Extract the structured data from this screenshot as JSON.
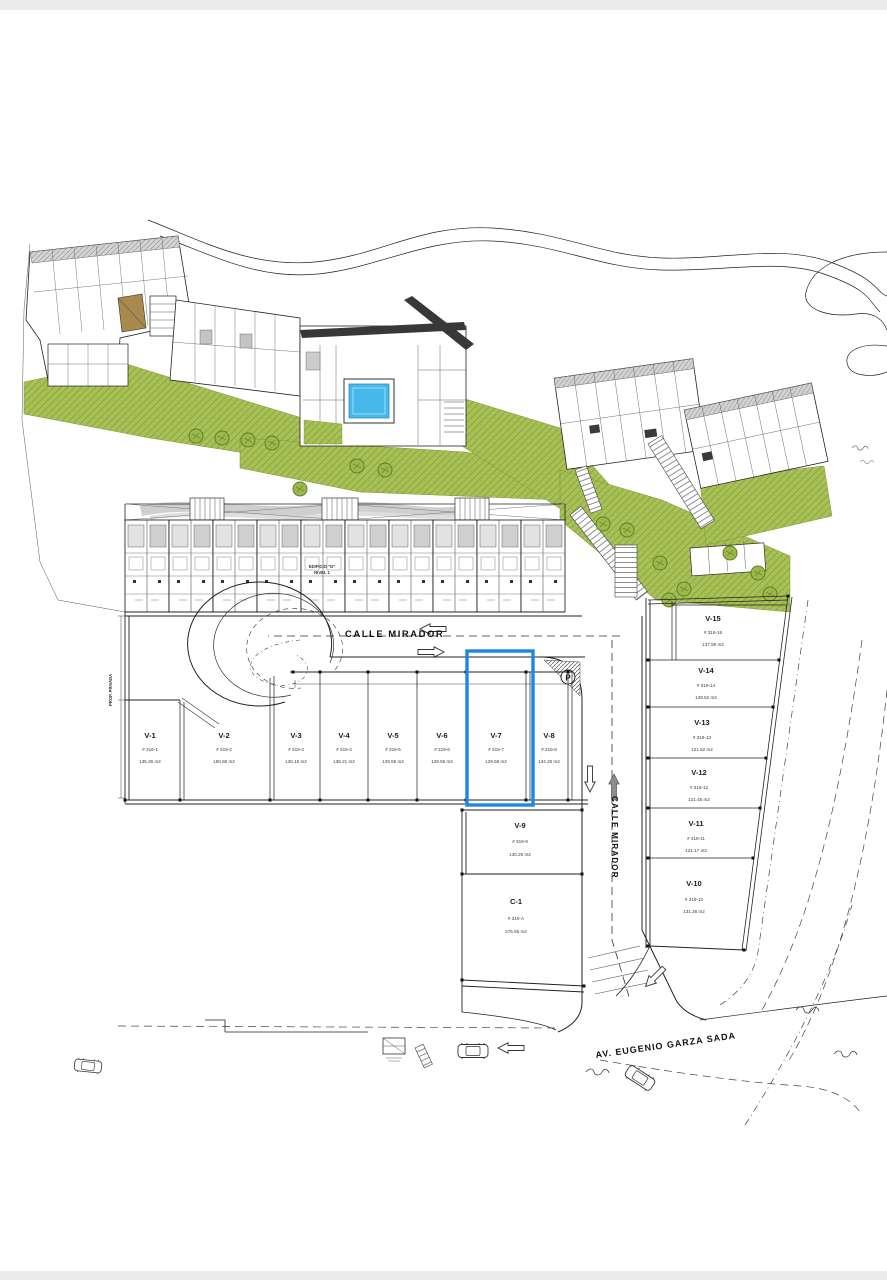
{
  "plan": {
    "title_area": "site plan",
    "streets": {
      "calle_mirador_horizontal": "CALLE MIRADOR",
      "calle_mirador_vertical": "CALLE MIRADOR",
      "avenue": "AV. EUGENIO GARZA SADA",
      "prop_privada": "PROP. PRIVADA",
      "parking_symbol": "P"
    },
    "building_label": {
      "line1": "EDIFICIO \"D\"",
      "line2": "NIVEL 1"
    },
    "lots": [
      {
        "id": "V-1",
        "unit": "# 319-1",
        "area": "135.36 m2"
      },
      {
        "id": "V-2",
        "unit": "# 319-2",
        "area": "180.86 m2"
      },
      {
        "id": "V-3",
        "unit": "# 319-3",
        "area": "130.15 m2"
      },
      {
        "id": "V-4",
        "unit": "# 319-4",
        "area": "138.21 m2"
      },
      {
        "id": "V-5",
        "unit": "# 319-5",
        "area": "129.59 m2"
      },
      {
        "id": "V-6",
        "unit": "# 319-6",
        "area": "129.59 m2"
      },
      {
        "id": "V-7",
        "unit": "# 319-7",
        "area": "129.59 m2"
      },
      {
        "id": "V-8",
        "unit": "# 319-8",
        "area": "134.25 m2"
      },
      {
        "id": "V-9",
        "unit": "# 319-9",
        "area": "130.25 m2"
      },
      {
        "id": "C-1",
        "unit": "# 319-A",
        "area": "275.55 m2"
      },
      {
        "id": "V-10",
        "unit": "# 319-10",
        "area": "131.36 m2"
      },
      {
        "id": "V-11",
        "unit": "# 319-11",
        "area": "121.17 m2"
      },
      {
        "id": "V-12",
        "unit": "# 319-12",
        "area": "121.45 m2"
      },
      {
        "id": "V-13",
        "unit": "# 319-13",
        "area": "121.52 m2"
      },
      {
        "id": "V-14",
        "unit": "# 319-14",
        "area": "128.52 m2"
      },
      {
        "id": "V-15",
        "unit": "# 319-15",
        "area": "137.59 m2"
      }
    ],
    "highlight": {
      "lot": "V-7",
      "color": "#1d86e8"
    },
    "colors": {
      "grass": "#a8c257",
      "pool": "#46b8ea",
      "roof_dark": "#383838",
      "letterbox": "#ececec",
      "line": "#222222"
    }
  }
}
